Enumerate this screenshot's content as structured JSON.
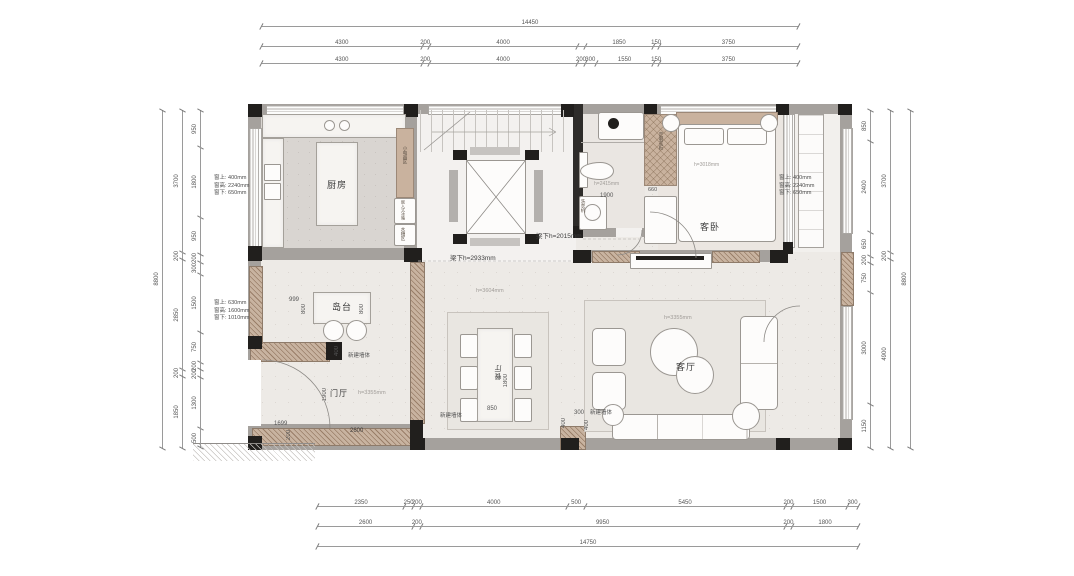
{
  "colors": {
    "wall_gray": "#a5a19d",
    "wall_black": "#211f1d",
    "wood": "#c9b29e",
    "floor": "#edeae6",
    "floor_kitchen": "#d9d5d1",
    "dim_text": "#555555"
  },
  "dims": {
    "top": {
      "total": {
        "labels": [
          "14450"
        ],
        "values": [
          14450
        ]
      },
      "mid": {
        "labels": [
          "4300",
          "200",
          "4000",
          "",
          "1850",
          "150",
          "3750"
        ],
        "values": [
          4300,
          200,
          4000,
          200,
          1850,
          150,
          3750
        ]
      },
      "inner": {
        "labels": [
          "4300",
          "200",
          "4000",
          "200",
          "300",
          "1550",
          "150",
          "3750"
        ],
        "values": [
          4300,
          200,
          4000,
          200,
          300,
          1550,
          150,
          3750
        ]
      }
    },
    "bottom": {
      "inner": {
        "labels": [
          "2350",
          "250",
          "200",
          "4000",
          "500",
          "5450",
          "200",
          "1500",
          "300"
        ],
        "values": [
          2350,
          250,
          200,
          4000,
          500,
          5450,
          200,
          1500,
          300
        ]
      },
      "mid": {
        "labels": [
          "2600",
          "200",
          "9950",
          "200",
          "1800"
        ],
        "values": [
          2600,
          200,
          9950,
          200,
          1800
        ]
      },
      "total": {
        "labels": [
          "14750"
        ],
        "values": [
          14750
        ]
      }
    },
    "left": {
      "outer": {
        "labels": [
          "8800"
        ],
        "values": [
          8800
        ]
      },
      "mid": {
        "labels": [
          "3700",
          "200",
          "2850",
          "200",
          "1850"
        ],
        "values": [
          3700,
          200,
          2850,
          200,
          1850
        ]
      },
      "inner": {
        "labels": [
          "950",
          "1800",
          "950",
          "200",
          "300",
          "1500",
          "750",
          "200",
          "200",
          "1300",
          "500"
        ],
        "values": [
          950,
          1800,
          950,
          200,
          300,
          1500,
          750,
          200,
          200,
          1300,
          500
        ]
      }
    },
    "right": {
      "inner": {
        "labels": [
          "850",
          "2400",
          "650",
          "200",
          "750",
          "3000",
          "1150"
        ],
        "values": [
          850,
          2400,
          650,
          200,
          750,
          3000,
          1150
        ]
      },
      "mid": {
        "labels": [
          "3700",
          "200",
          "4900"
        ],
        "values": [
          3700,
          200,
          4900
        ]
      },
      "outer": {
        "labels": [
          "8800"
        ],
        "values": [
          8800
        ]
      }
    }
  },
  "rooms": {
    "kitchen": "厨房",
    "island": "岛台",
    "foyer": "门厅",
    "dining": "餐厅",
    "living": "客厅",
    "bedroom": "客卧"
  },
  "kitchen": {
    "appliance_zone": "小电器区",
    "fridge": "嵌入式冰箱",
    "sink_zone": "水槽区"
  },
  "bath": {
    "washer": "洗衣机",
    "ceiling": "h=2415mm",
    "dim_1900": "1900"
  },
  "wardrobe": {
    "label": "定制衣柜",
    "dim_660": "660"
  },
  "bedroom": {
    "ceiling": "h=3018mm"
  },
  "annotations": {
    "window_kitchen": {
      "l1": "窗上: 400mm",
      "l2": "窗高: 2240mm",
      "l3": "窗下: 650mm"
    },
    "window_dining": {
      "l1": "窗上: 630mm",
      "l2": "窗高: 1600mm",
      "l3": "窗下: 1010mm"
    },
    "window_bedroom": {
      "l1": "窗上: 400mm",
      "l2": "窗高: 2240mm",
      "l3": "窗下: 650mm"
    },
    "beam_1": "梁下h=2933mm",
    "beam_2": "梁下h=2015mm",
    "new_wall": "新建墙体",
    "foyer_ceiling": "h=3355mm",
    "living_ceiling": "h=3355mm",
    "dining_ceiling": "h=3604mm"
  },
  "plan_dims": {
    "island_999": "999",
    "island_800a": "800",
    "island_800b": "800",
    "wall_400": "400",
    "foyer_1900": "1900",
    "wall_2600": "2600",
    "ext_1699": "1699",
    "ext_200": "200",
    "table_850": "850",
    "table_1800": "1800",
    "living_300": "300",
    "living_400a": "400",
    "living_400b": "400"
  }
}
